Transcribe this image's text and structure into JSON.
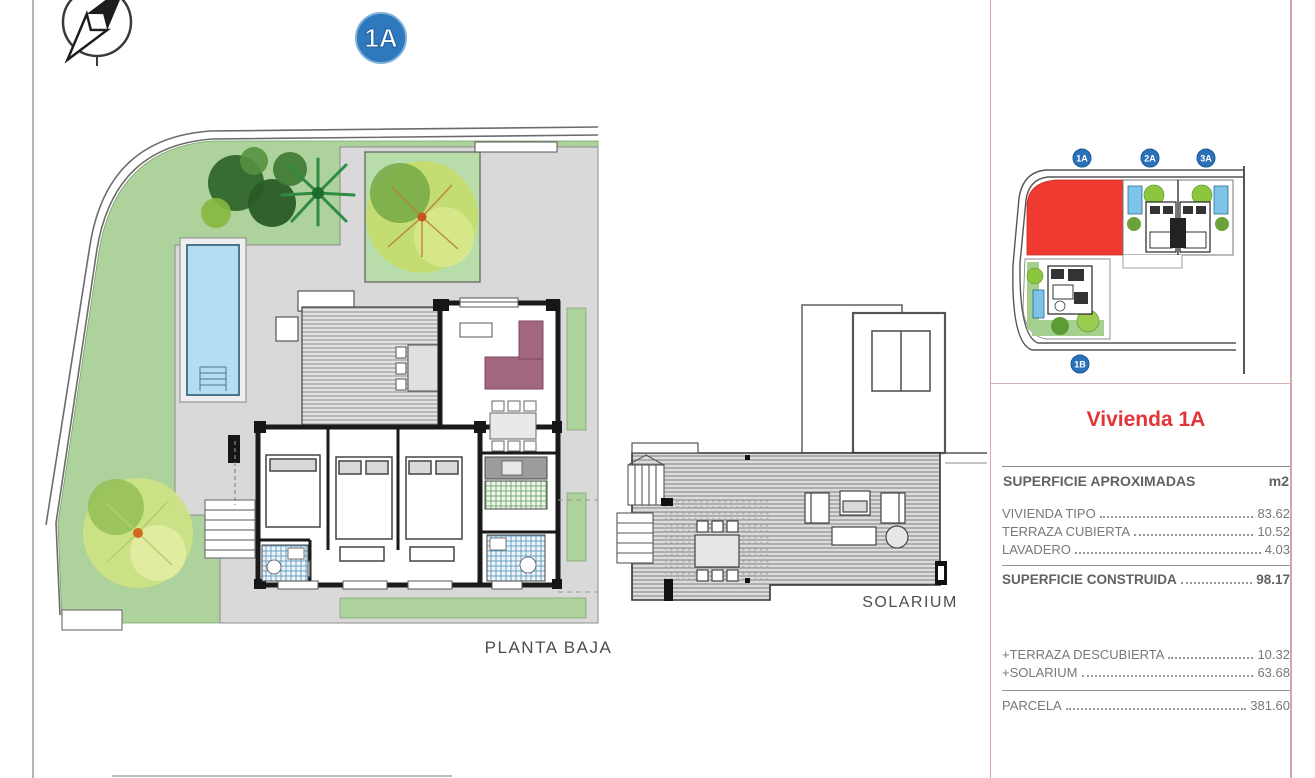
{
  "page": {
    "badge": "1A",
    "planta_baja_label": "PLANTA BAJA",
    "solarium_label": "SOLARIUM"
  },
  "site_plan": {
    "badges": {
      "a1": "1A",
      "a2": "2A",
      "a3": "3A",
      "b1": "1B"
    },
    "highlight_color": "#ee3a30",
    "badge_color": "#2a71b8"
  },
  "plan_colors": {
    "garden_green": "#aed29c",
    "pool_blue": "#b5ddf2",
    "terrace_gray": "#d9d9d9",
    "sofa_purple": "#a2667f"
  },
  "info_panel": {
    "title": "Vivienda 1A",
    "title_color": "#e23537",
    "header": {
      "label": "SUPERFICIE APROXIMADAS",
      "unit": "m2"
    },
    "rows": [
      {
        "label": "VIVIENDA TIPO",
        "value": "83.62"
      },
      {
        "label": "TERRAZA CUBIERTA",
        "value": "10.52"
      },
      {
        "label": "LAVADERO",
        "value": "4.03"
      }
    ],
    "total": {
      "label": "SUPERFICIE CONSTRUIDA",
      "value": "98.17"
    },
    "extras": [
      {
        "label": "+TERRAZA DESCUBIERTA",
        "value": "10.32"
      },
      {
        "label": "+SOLARIUM",
        "value": "63.68"
      }
    ],
    "parcela": {
      "label": "PARCELA",
      "value": "381.60"
    }
  }
}
